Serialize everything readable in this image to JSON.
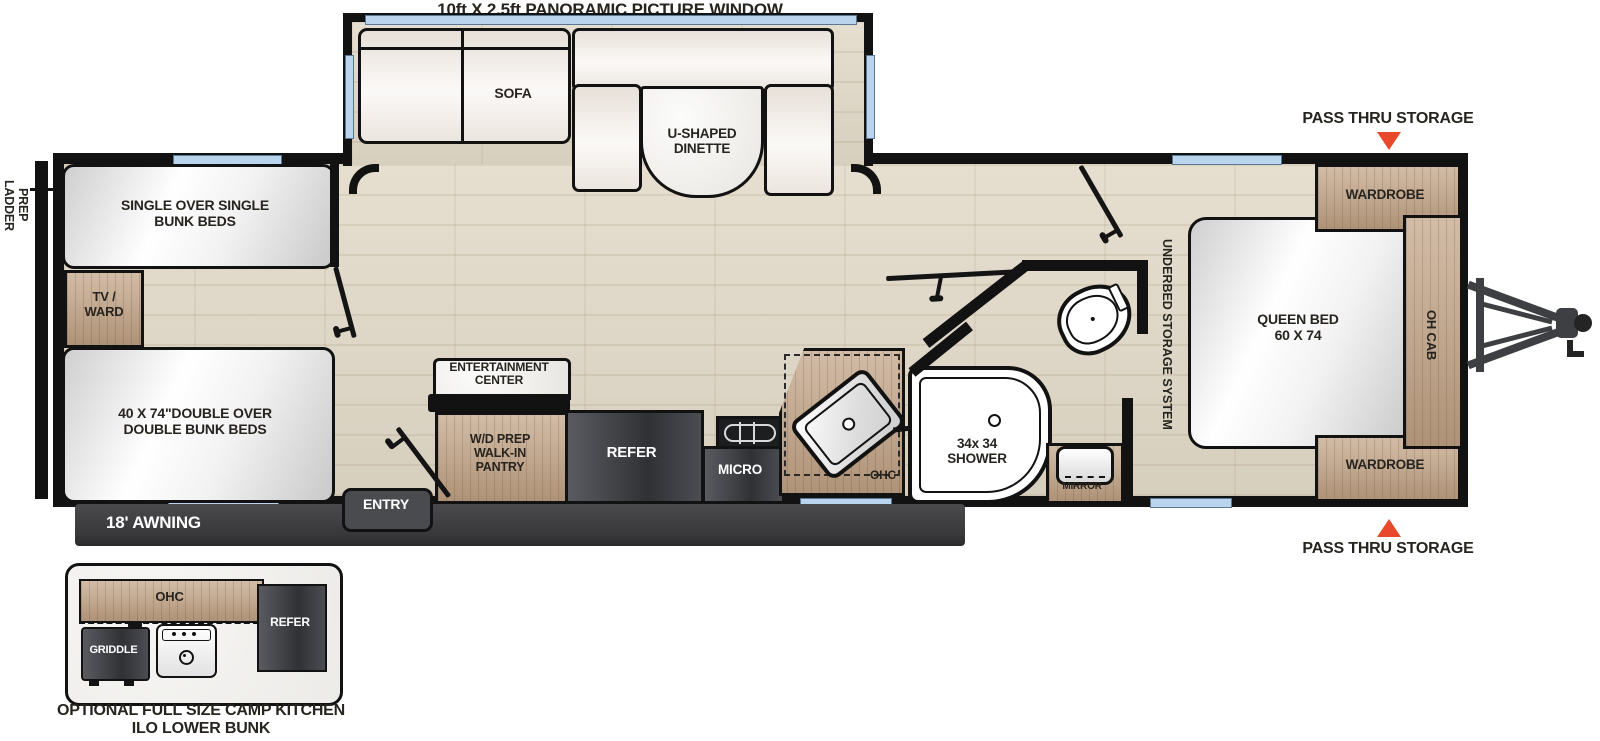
{
  "colors": {
    "accent_orange": "#e8492b",
    "wall_black": "#121212",
    "wood_tan": "#c2a385",
    "appliance_gray": "#3a3c40",
    "window_blue": "#b9d4ec",
    "awning_gray": "#414144"
  },
  "header": {
    "panoramic_window": "10ft X 2.5ft PANORAMIC PICTURE WINDOW"
  },
  "slideout": {
    "sofa": "SOFA",
    "dinette": [
      "U-SHAPED",
      "DINETTE"
    ]
  },
  "rear": {
    "ladder_prep": [
      "LADDER",
      "PREP"
    ],
    "single_bunks": [
      "SINGLE OVER SINGLE",
      "BUNK BEDS"
    ],
    "tv_ward": [
      "TV /",
      "WARD"
    ],
    "double_bunks": [
      "40 X 74\"DOUBLE OVER",
      "DOUBLE BUNK BEDS"
    ]
  },
  "kitchen": {
    "entertainment": [
      "ENTERTAINMENT",
      "CENTER"
    ],
    "pantry": [
      "W/D PREP",
      "WALK-IN",
      "PANTRY"
    ],
    "refer": "REFER",
    "micro": "MICRO",
    "ohc": "OHC"
  },
  "bath": {
    "shower": [
      "34x 34",
      "SHOWER"
    ],
    "mirror": "MIRROR"
  },
  "bedroom": {
    "underbed": "UNDERBED STORAGE SYSTEM",
    "queen_bed": [
      "QUEEN BED",
      "60 X 74"
    ],
    "wardrobe_top": "WARDROBE",
    "wardrobe_bottom": "WARDROBE",
    "oh_cab": "OH CAB",
    "pass_thru_top": "PASS THRU STORAGE",
    "pass_thru_bottom": "PASS THRU STORAGE"
  },
  "exterior": {
    "awning": "18' AWNING",
    "entry": "ENTRY"
  },
  "inset": {
    "ohc": "OHC",
    "griddle": "GRIDDLE",
    "refer": "REFER",
    "caption": [
      "OPTIONAL FULL SIZE CAMP KITCHEN",
      "ILO LOWER BUNK"
    ]
  }
}
